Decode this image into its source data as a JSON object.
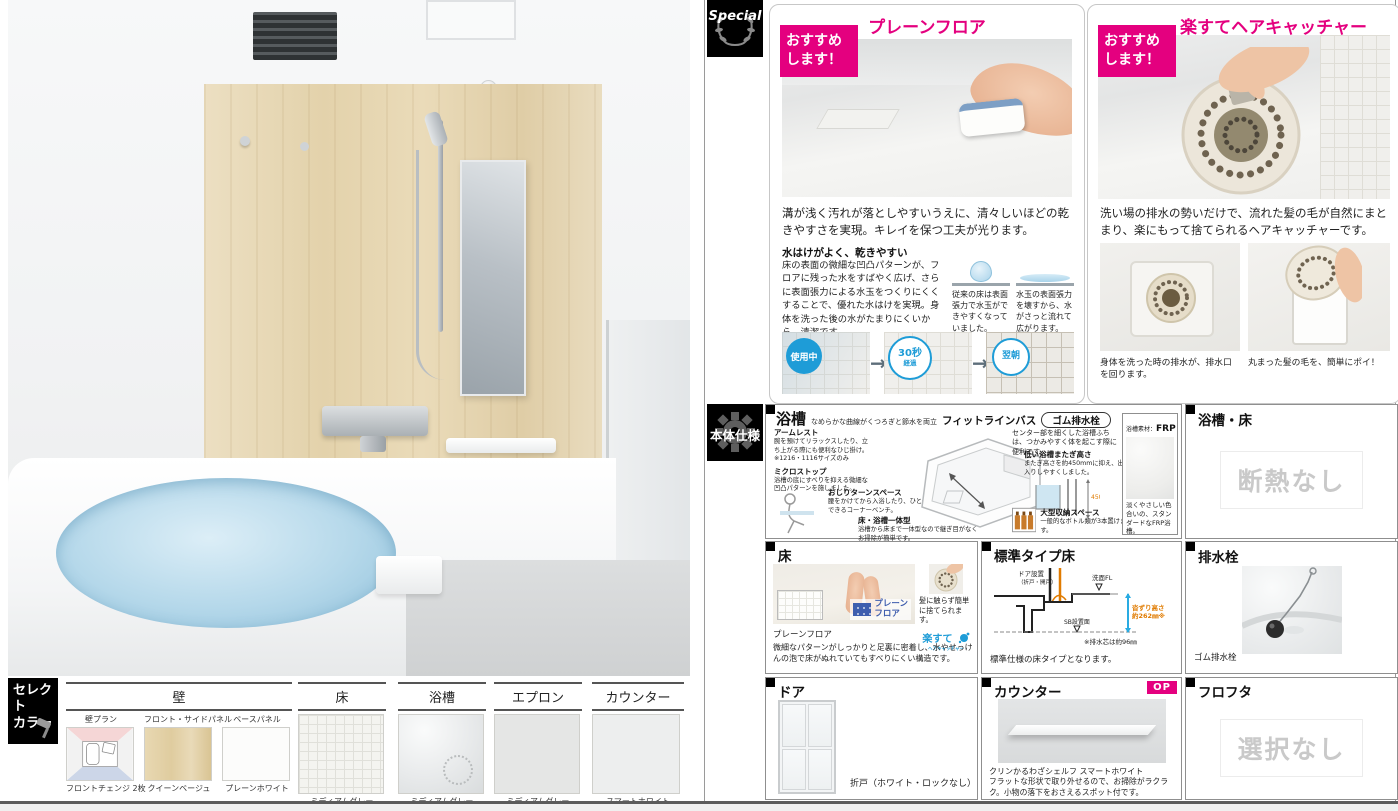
{
  "colors": {
    "accent_pink": "#e4007f",
    "circle_blue": "#1e9cd7",
    "logo_blue": "#3f5eae",
    "disabled_gray": "#c9c9c9"
  },
  "select_color": {
    "badge1": "セレクト",
    "badge2": "カラー",
    "wall": {
      "header": "壁",
      "items": [
        {
          "top": "壁プラン",
          "bottom": "フロントチェンジ 2枚"
        },
        {
          "top": "フロント・サイドパネル",
          "bottom": "クイーンベージュ"
        },
        {
          "top": "ベースパネル",
          "bottom": "プレーンホワイト"
        }
      ]
    },
    "floor": {
      "header": "床",
      "label": "ミディアムグレー"
    },
    "bathtub": {
      "header": "浴槽",
      "label": "ミディアムグレー"
    },
    "apron": {
      "header": "エプロン",
      "label": "ミディアムグレー"
    },
    "counter": {
      "header": "カウンター",
      "label": "スマートホワイト"
    }
  },
  "special": {
    "badge": "Special",
    "recommend1": "おすすめ",
    "recommend2": "します！",
    "plain_floor": {
      "title": "プレーンフロア",
      "lead": "溝が浅く汚れが落としやすいうえに、清々しいほどの乾きやすさを実現。キレイを保つ工夫が光ります。",
      "subhead": "水はけがよく、乾きやすい",
      "body": "床の表面の微細な凹凸パターンが、フロアに残った水をすばやく広げ、さらに表面張力による水玉をつくりにくくすることで、優れた水はけを実現。身体を洗った後の水がたまりにくいから、清潔です。",
      "cap_left": "従来の床は表面張力で水玉ができやすくなっていました。",
      "cap_right": "水玉の表面張力を壊すから、水がさっと流れて広がります。",
      "step1": "使用中",
      "step2a": "30秒",
      "step2b": "経過",
      "step3": "翌朝"
    },
    "hair": {
      "title": "楽すてヘアキャッチャー",
      "lead": "洗い場の排水の勢いだけで、流れた髪の毛が自然にまとまり、楽にもって捨てられるヘアキャッチャーです。",
      "cap_left": "身体を洗った時の排水が、排水口を回ります。",
      "cap_right": "丸まった髪の毛を、簡単にポイ！"
    }
  },
  "spec": {
    "badge": "本体仕様",
    "bathtub": {
      "title": "浴槽",
      "subtitle": "なめらかな曲線がくつろぎと節水を両立",
      "product": "フィットラインバス",
      "drain_badge": "ゴム排水栓",
      "armrest_t": "アームレスト",
      "armrest_x": "腕を預けてリラックスしたり、立ち上がる際にも便利なひじ掛け。 ※1216・1116サイズのみ",
      "micro_t": "ミクロストップ",
      "micro_x": "浴槽の底にすべりを抑える微細な凹凸パターンを施しました。",
      "turn_t": "おしりターンスペース",
      "turn_x": "腰をかけてから入浴したり、ひと休みできるコーナーベンチ。",
      "one_t": "床・浴槽一体型",
      "one_x": "浴槽から床まで一体型なので継ぎ目がなくお掃除が簡単です。",
      "center_x": "センター部を細くした浴槽ふちは、つかみやすく体を起こす際に便利です。",
      "low_t": "低い浴槽またぎ高さ",
      "low_x": "またぎ高さを約450mmに抑え、出入りしやすくしました。",
      "low_dim": "450",
      "storage_t": "大型収納スペース",
      "storage_x": "一般的なボトル類が3本置けます。",
      "mat_label": "浴槽素材：",
      "mat_value": "FRP",
      "mat_x": "淡くやさしい色合いの、スタンダードなFRP浴槽。"
    },
    "tub_floor": {
      "title": "浴槽・床",
      "value": "断熱なし"
    },
    "floor": {
      "title": "床",
      "logo1": "プレーン",
      "logo2": "フロア",
      "note": "髪に触らず簡単に捨てられます。",
      "rakusute": "楽すて",
      "rakusute_sub": "ヘアキャッチャー",
      "cap_t": "プレーンフロア",
      "cap_x": "微細なパターンがしっかりと足裏に密着し、水やせっけんの泡で床がぬれていてもすべりにくい構造です。"
    },
    "std": {
      "title": "標準タイプ床",
      "door1": "ドア設置",
      "door2": "（折戸・開戸）",
      "fl": "洗面FL",
      "sb": "SB設置面",
      "h1": "沓ずり高さ",
      "h2": "約262㎜※",
      "drain_note": "※排水芯は約96㎜",
      "caption": "標準仕様の床タイプとなります。"
    },
    "drain": {
      "title": "排水栓",
      "caption": "ゴム排水栓"
    },
    "door": {
      "title": "ドア",
      "caption": "折戸（ホワイト・ロックなし）"
    },
    "counter": {
      "title": "カウンター",
      "op": "OP",
      "cap_t": "クリンかるわざシェルフ スマートホワイト",
      "cap_x": "フラットな形状で取り外せるので、お掃除がラクラク。小物の落下をおさえるスポット付です。"
    },
    "futa": {
      "title": "フロフタ",
      "value": "選択なし"
    }
  }
}
